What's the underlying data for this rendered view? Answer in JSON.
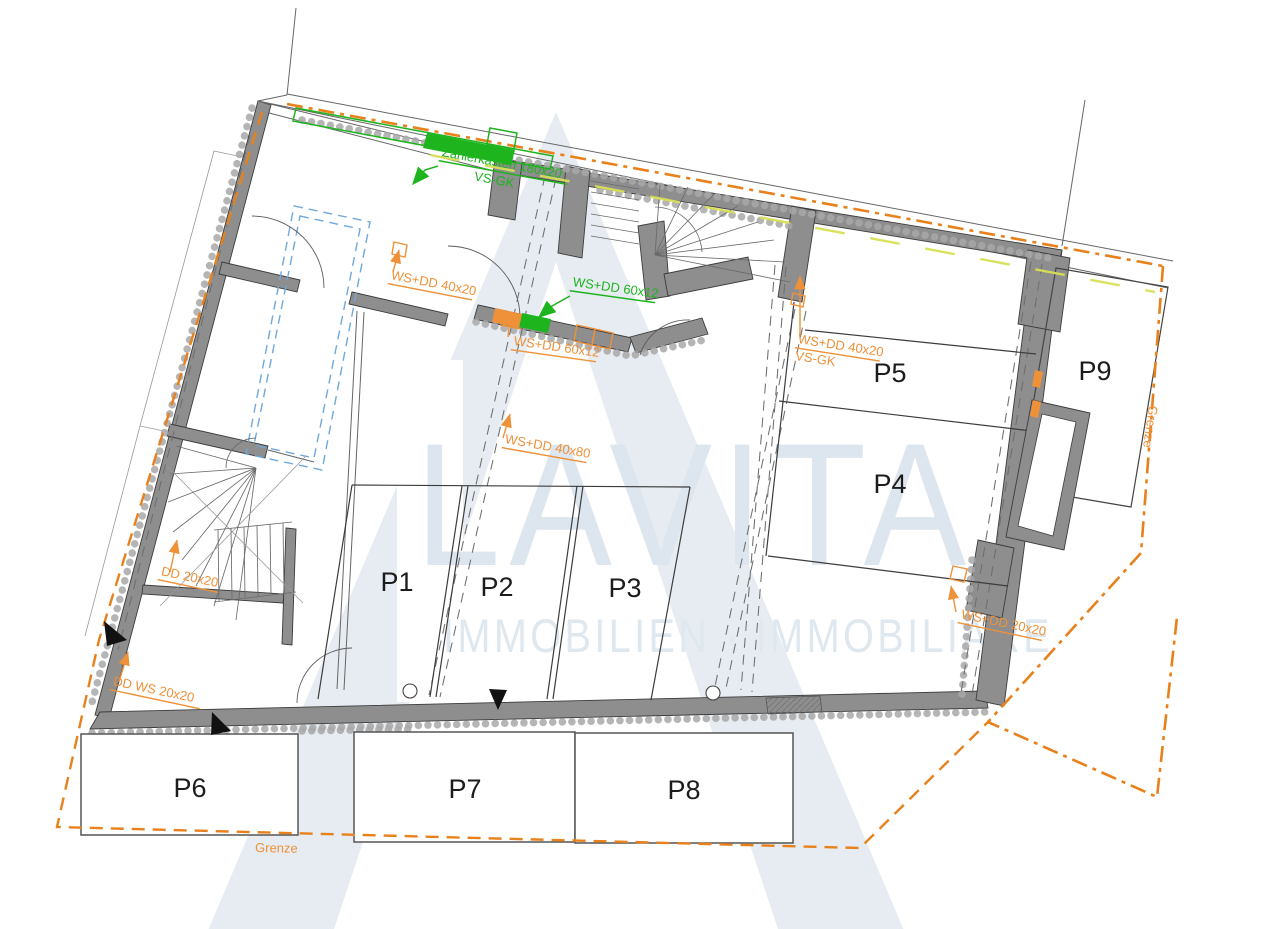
{
  "watermark": {
    "brand": "LAVITA",
    "subtitle": "IMMOBILIEN · IMMOBILIARE"
  },
  "parking": {
    "p1": "P1",
    "p2": "P2",
    "p3": "P3",
    "p4": "P4",
    "p5": "P5",
    "p6": "P6",
    "p7": "P7",
    "p8": "P8",
    "p9": "P9"
  },
  "boundary": {
    "bottom_label": "Grenze",
    "right_label": "Grenze"
  },
  "annotations": {
    "meter_cabinet": "Zählerkasten 180x20",
    "meter_cabinet_type": "VS-GK",
    "green_ws_dd": "WS+DD 60x12",
    "orange_ws_dd_60x12": "WS+DD 60x12",
    "orange_ws_dd_40x20_top": "WS+DD 40x20",
    "orange_ws_dd_40x80": "WS+DD 40x80",
    "orange_ws_dd_40x20_p5": "WS+DD 40x20",
    "orange_vs_gk_p5": "VS-GK",
    "orange_dd_20x20": "DD 20x20",
    "orange_dd_ws_20x20": "DD WS 20x20",
    "orange_ws_dd_20x20_right": "WS+DD 20x20"
  },
  "colors": {
    "wall_gray": "#8e8e8e",
    "line_dark": "#3c3c3c",
    "boundary_orange": "#e8811c",
    "annotation_orange": "#ee9138",
    "annotation_green": "#1eb41e",
    "yellow_green": "#d7df55",
    "blue_dashed": "#6fa8dc",
    "watermark_fill": "#e6ecf2",
    "watermark_text": "#dde5ee"
  }
}
